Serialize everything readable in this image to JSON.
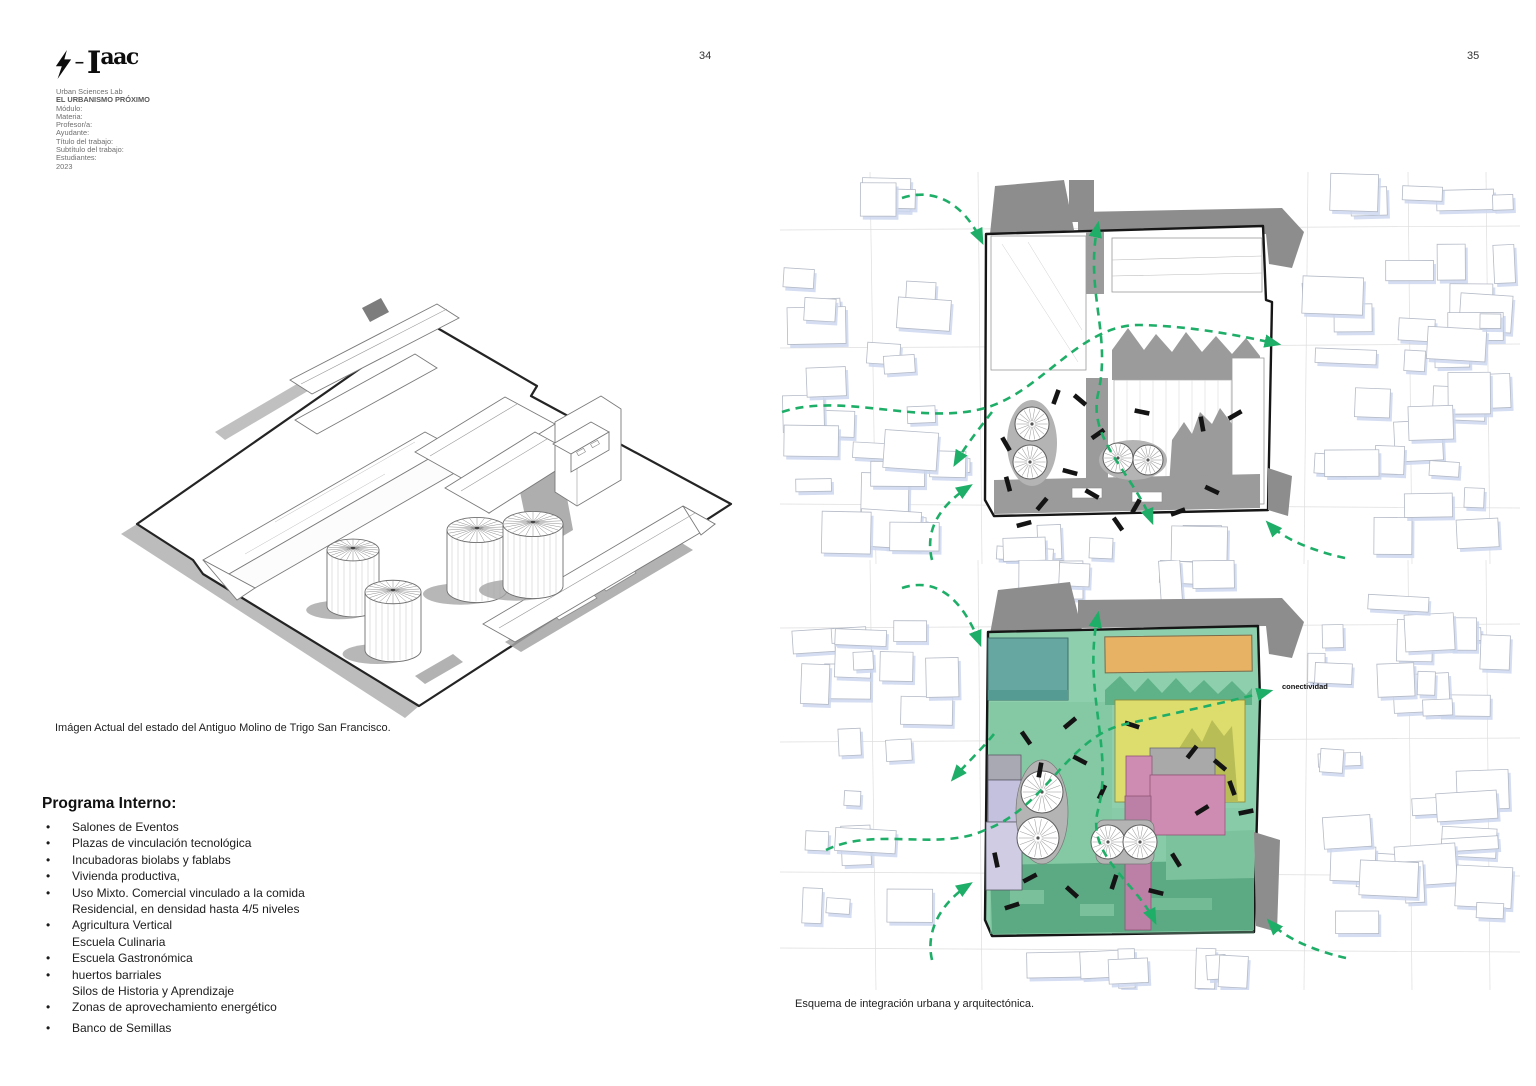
{
  "header": {
    "lab": "Urban Sciences Lab",
    "title": "EL URBANISMO PRÓXIMO",
    "fields": [
      "Módulo:",
      "Materia:",
      "Profesor/a:",
      "Ayudante:",
      "Título del trabajo:",
      "Subtítulo del trabajo:",
      "Estudiantes:",
      "2023"
    ]
  },
  "logo": {
    "i": "I",
    "suffix": "aac",
    "dash": "–"
  },
  "pages": {
    "left": {
      "number": "34"
    },
    "right": {
      "number": "35"
    }
  },
  "left": {
    "axon_caption": "Imágen Actual del estado del Antiguo Molino de Trigo San Francisco.",
    "program": {
      "heading": "Programa Interno:",
      "items": [
        {
          "b": "•",
          "t": "Salones de Eventos"
        },
        {
          "b": "•",
          "t": "Plazas de vinculación tecnológica"
        },
        {
          "b": "•",
          "t": "Incubadoras biolabs y fablabs"
        },
        {
          "b": "•",
          "t": "Vivienda productiva,"
        },
        {
          "b": "•",
          "t": "Uso Mixto. Comercial vinculado a la comida"
        },
        {
          "b": "",
          "t": "Residencial, en densidad hasta 4/5 niveles"
        },
        {
          "b": "•",
          "t": "Agricultura Vertical"
        },
        {
          "b": "",
          "t": "Escuela Culinaria"
        },
        {
          "b": "•",
          "t": "Escuela Gastronómica"
        },
        {
          "b": "•",
          "t": "huertos barriales"
        },
        {
          "b": "",
          "t": "Silos de Historia y Aprendizaje"
        },
        {
          "b": "•",
          "t": "Zonas de aprovechamiento energético"
        },
        {
          "b": "•",
          "t": "Banco de Semillas"
        }
      ]
    }
  },
  "right": {
    "caption": "Esquema de integración urbana y arquitectónica.",
    "connectivity_label": "conectividad"
  },
  "colors": {
    "arrow_green": "#1fae68",
    "site_green": "#8ed0ae",
    "mid_green": "#7cc29d",
    "saw_green": "#5fb287",
    "deep_green": "#5caa84",
    "teal": "#66a7a1",
    "orange": "#e8b264",
    "yellow": "#dddd6d",
    "olive": "#b9bd55",
    "pink": "#cf8cb2",
    "mauve": "#bc7fa6",
    "lavender": "#c4c1de",
    "lavender_light": "#cfcce4",
    "slate": "#a9a9b4",
    "gray_mass": "#8d8d8d",
    "shadow_gray": "#9b9b9b",
    "silo_gray": "#b4b4b4",
    "context_shadow": "#ccd7ee",
    "context_stroke": "#b4bac6",
    "grid_gray": "#dedede",
    "ink": "#1a1a1a",
    "text_gray": "#6f6f6f"
  }
}
